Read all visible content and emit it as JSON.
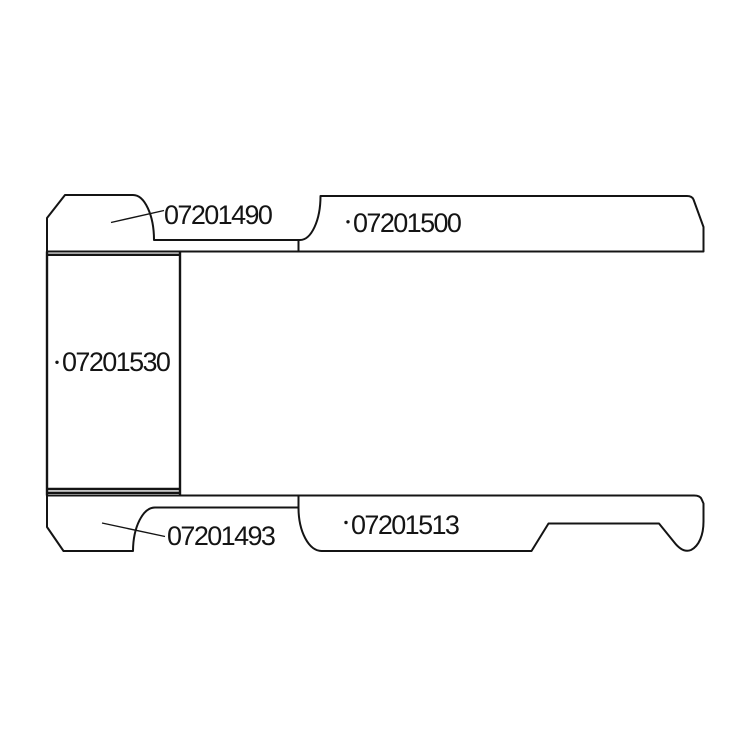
{
  "diagram": {
    "kind": "technical-parts-line-diagram",
    "description_visible_elements": "five outlined panel shapes with part number labels"
  },
  "colors": {
    "background": "#ffffff",
    "line": "#141414",
    "text": "#141414"
  },
  "parts": [
    {
      "key": "top-left-panel",
      "number": "07201490"
    },
    {
      "key": "top-right-panel",
      "number": "07201500"
    },
    {
      "key": "left-rectangle-panel",
      "number": "07201530"
    },
    {
      "key": "bottom-left-panel",
      "number": "07201493"
    },
    {
      "key": "bottom-right-panel",
      "number": "07201513"
    }
  ]
}
